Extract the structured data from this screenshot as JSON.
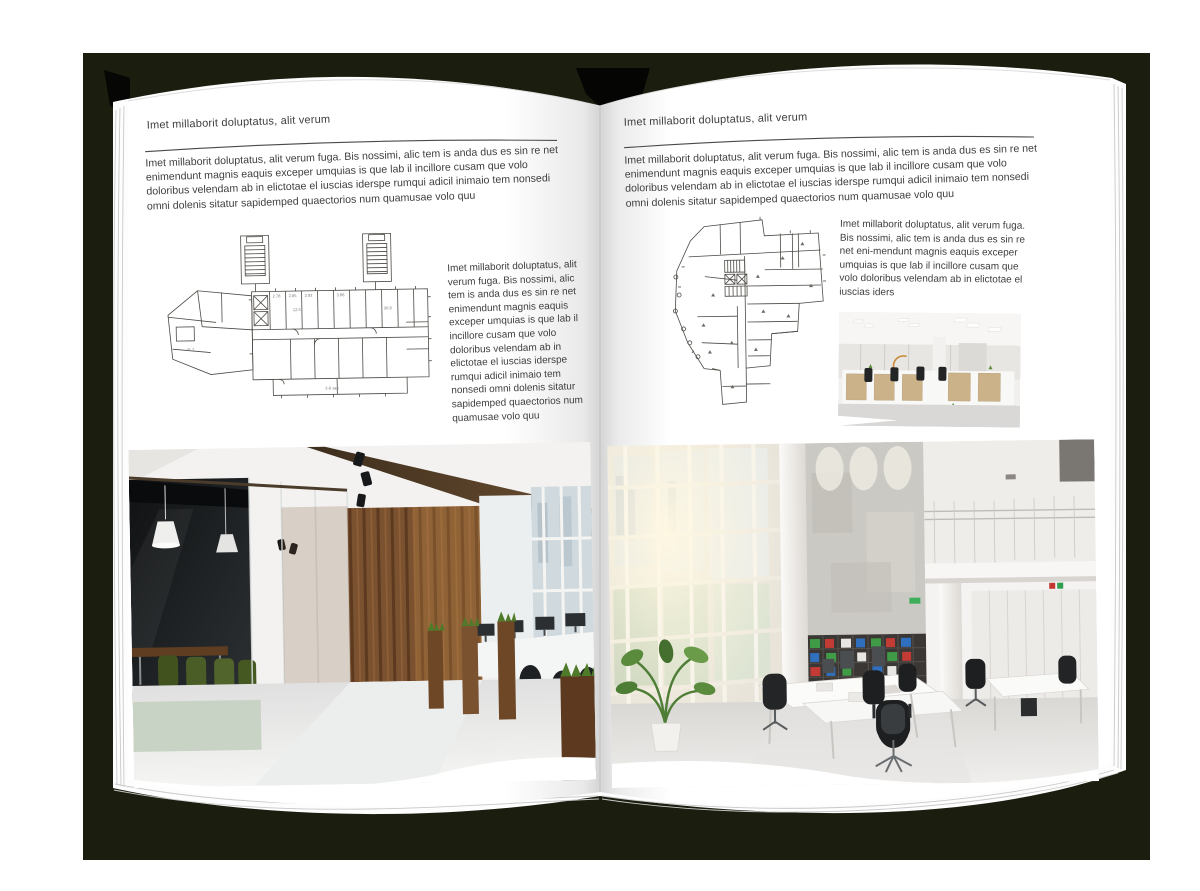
{
  "left_page": {
    "header": "Imet millaborit doluptatus, alit verum",
    "intro": "Imet millaborit doluptatus, alit verum fuga. Bis nossimi, alic tem is anda dus es sin re net enimendunt magnis eaquis exceper umquias is que lab il incillore cusam que volo doloribus velendam ab in elictotae el iuscias iderspe rumqui adicil inimaio tem nonsedi omni dolenis sitatur sapidemped quaectorios num quamusae volo quu",
    "caption": "Imet millaborit doluptatus, alit verum fuga. Bis nossimi, alic tem is anda dus es sin re net enimendunt magnis eaquis exceper umquias is que lab il incillore cusam que volo doloribus velendam ab in elictotae el iuscias iderspe rumqui adicil inimaio tem nonsedi omni dolenis sitatur sapidemped quaectorios num quamusae volo quu",
    "plan_labels": [
      "2.78",
      "2.85",
      "2.92",
      "3.86",
      "12.5",
      "30.8",
      "41.7",
      "2-й зал"
    ]
  },
  "right_page": {
    "header": "Imet millaborit doluptatus, alit verum",
    "intro": "Imet millaborit doluptatus, alit verum fuga. Bis nossimi, alic tem is anda dus es sin re net enimendunt magnis eaquis exceper umquias is que lab il incillore cusam que volo doloribus velendam ab in elictotae el iuscias iderspe rumqui adicil inimaio tem nonsedi omni dolenis sitatur sapidemped quaectorios num quamusae volo quu",
    "caption": "Imet millaborit doluptatus, alit verum fuga. Bis nossimi, alic tem is anda dus es sin re net eni-mendunt magnis eaquis exceper umquias is que lab il incillore cusam que volo doloribus velendam ab in elictotae el iuscias iders"
  },
  "images": {
    "left_floorplan": "building-floor-plan",
    "right_floorplan": "building-floor-plan",
    "left_photo": "loft-office-interior-photo",
    "right_small_photo": "open-space-office-photo",
    "right_photo": "atrium-office-interior-photo"
  },
  "colors": {
    "backdrop": "#1b1e0e",
    "page": "#ffffff",
    "plan_line": "#4d4a45",
    "body_text": "#3e3e3e",
    "wood": "#7b5230",
    "plant_green": "#4f7a2a"
  }
}
